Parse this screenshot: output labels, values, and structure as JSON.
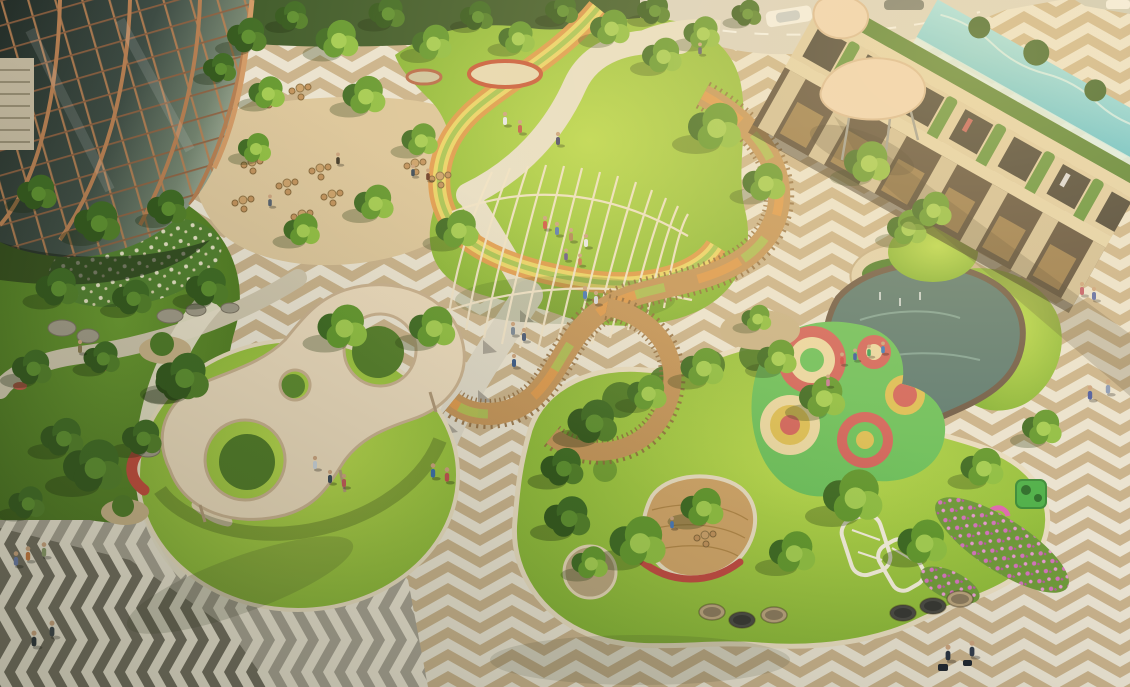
{
  "scene": {
    "title": "Aerial architectural rendering of a landscaped mixed-use plaza and park at golden hour",
    "elements": [
      "glass-office-tower",
      "cafe-terrace",
      "street-with-cars",
      "central-lawn",
      "lattice-pavilion",
      "rainbow-loop-path",
      "elevated-timber-ramp",
      "sculpted-canopy-pavilion",
      "play-mound-with-slides",
      "chevron-plaza",
      "retail-arcade-building",
      "rooftop-pool",
      "umbrella-canopy",
      "water-feature",
      "playground-mat",
      "flower-beds",
      "lounge-pods",
      "white-trellis",
      "garden-with-boulders"
    ],
    "trees": [
      [
        245,
        38,
        1.2,
        "d"
      ],
      [
        290,
        18,
        1.0,
        "d"
      ],
      [
        335,
        42,
        1.3,
        "m"
      ],
      [
        385,
        15,
        1.1,
        "d"
      ],
      [
        430,
        45,
        1.2,
        "m"
      ],
      [
        475,
        18,
        1.0,
        "d"
      ],
      [
        515,
        40,
        1.1,
        "m"
      ],
      [
        560,
        12,
        1.0,
        "d"
      ],
      [
        608,
        30,
        1.2,
        "m"
      ],
      [
        652,
        12,
        1.0,
        "d"
      ],
      [
        700,
        35,
        1.1,
        "m"
      ],
      [
        745,
        15,
        0.9,
        "d"
      ],
      [
        218,
        70,
        1.0,
        "d"
      ],
      [
        265,
        95,
        1.1,
        "m"
      ],
      [
        362,
        98,
        1.3,
        "m"
      ],
      [
        418,
        142,
        1.1,
        "m"
      ],
      [
        372,
        205,
        1.2,
        "m"
      ],
      [
        300,
        232,
        1.1,
        "m"
      ],
      [
        253,
        150,
        1.0,
        "m"
      ],
      [
        455,
        232,
        1.3,
        "m"
      ],
      [
        35,
        195,
        1.2,
        "d"
      ],
      [
        95,
        225,
        1.4,
        "d"
      ],
      [
        165,
        210,
        1.2,
        "d"
      ],
      [
        55,
        290,
        1.3,
        "d"
      ],
      [
        130,
        300,
        1.2,
        "d"
      ],
      [
        205,
        290,
        1.3,
        "d"
      ],
      [
        30,
        370,
        1.2,
        "d"
      ],
      [
        100,
        360,
        1.1,
        "d"
      ],
      [
        175,
        385,
        1.3,
        "d"
      ],
      [
        60,
        440,
        1.3,
        "d"
      ],
      [
        140,
        440,
        1.2,
        "d"
      ],
      [
        90,
        470,
        1.8,
        "d"
      ],
      [
        25,
        505,
        1.1,
        "d"
      ],
      [
        180,
        380,
        1.6,
        "d"
      ],
      [
        340,
        330,
        1.5,
        "m"
      ],
      [
        430,
        330,
        1.4,
        "m"
      ],
      [
        712,
        130,
        1.6,
        "m"
      ],
      [
        762,
        185,
        1.3,
        "m"
      ],
      [
        660,
        58,
        1.2,
        "m"
      ],
      [
        865,
        165,
        1.4,
        "m"
      ],
      [
        905,
        230,
        1.2,
        "m"
      ],
      [
        930,
        212,
        1.2,
        "m"
      ],
      [
        590,
        425,
        1.5,
        "d"
      ],
      [
        645,
        395,
        1.2,
        "m"
      ],
      [
        700,
        370,
        1.3,
        "m"
      ],
      [
        560,
        470,
        1.3,
        "d"
      ],
      [
        775,
        360,
        1.2,
        "m"
      ],
      [
        820,
        400,
        1.4,
        "m"
      ],
      [
        635,
        545,
        1.7,
        "m"
      ],
      [
        565,
        520,
        1.4,
        "d"
      ],
      [
        700,
        510,
        1.3,
        "m"
      ],
      [
        850,
        500,
        1.8,
        "m"
      ],
      [
        920,
        545,
        1.5,
        "m"
      ],
      [
        790,
        555,
        1.4,
        "m"
      ],
      [
        980,
        470,
        1.3,
        "m"
      ],
      [
        1040,
        430,
        1.2,
        "m"
      ],
      [
        588,
        565,
        1.1,
        "m"
      ],
      [
        755,
        320,
        0.9,
        "m"
      ]
    ],
    "people": [
      [
        80,
        346,
        1,
        "#8a7a52"
      ],
      [
        433,
        470,
        1.1,
        "#3a6ea8"
      ],
      [
        447,
        474,
        1.1,
        "#c05050"
      ],
      [
        505,
        118,
        1,
        "#e8e8ee"
      ],
      [
        520,
        126,
        1,
        "#c05a4a"
      ],
      [
        558,
        138,
        1,
        "#48486a"
      ],
      [
        545,
        222,
        1,
        "#d05848"
      ],
      [
        557,
        228,
        1,
        "#5a7ab0"
      ],
      [
        571,
        234,
        1,
        "#b08858"
      ],
      [
        586,
        240,
        1,
        "#e8e8e8"
      ],
      [
        566,
        254,
        0.9,
        "#6a5a8a"
      ],
      [
        580,
        259,
        0.9,
        "#c87850"
      ],
      [
        585,
        292,
        1,
        "#4878b8"
      ],
      [
        596,
        297,
        1,
        "#d8d8e0"
      ],
      [
        513,
        328,
        1,
        "#7a8898"
      ],
      [
        524,
        334,
        1,
        "#4a5a78"
      ],
      [
        514,
        360,
        1,
        "#385888"
      ],
      [
        413,
        170,
        0.9,
        "#384858"
      ],
      [
        428,
        174,
        0.9,
        "#6a3a28"
      ],
      [
        338,
        158,
        0.9,
        "#403828"
      ],
      [
        270,
        200,
        0.9,
        "#55606e"
      ],
      [
        28,
        553,
        1.1,
        "#c87840"
      ],
      [
        44,
        549,
        1.1,
        "#8a9a6a"
      ],
      [
        16,
        558,
        1.1,
        "#6878a8"
      ],
      [
        52,
        628,
        1.2,
        "#384048"
      ],
      [
        34,
        638,
        1.2,
        "#283038"
      ],
      [
        948,
        652,
        1.2,
        "#283240"
      ],
      [
        972,
        648,
        1.2,
        "#323c4c"
      ],
      [
        1082,
        288,
        1,
        "#c05868"
      ],
      [
        1094,
        293,
        1,
        "#5868a8"
      ],
      [
        1090,
        392,
        1.1,
        "#4858a0"
      ],
      [
        1108,
        386,
        1.1,
        "#8898b8"
      ],
      [
        842,
        358,
        0.9,
        "#d04848"
      ],
      [
        855,
        354,
        0.9,
        "#3858a0"
      ],
      [
        869,
        350,
        0.9,
        "#38a058"
      ],
      [
        883,
        347,
        0.9,
        "#3878c0"
      ],
      [
        828,
        380,
        0.9,
        "#c87898"
      ],
      [
        315,
        462,
        1,
        "#c8d0d8"
      ],
      [
        330,
        476,
        1,
        "#384858"
      ],
      [
        344,
        480,
        1,
        "#c05858"
      ],
      [
        672,
        522,
        0.9,
        "#4878b8"
      ],
      [
        700,
        48,
        0.9,
        "#5a5a6a"
      ]
    ],
    "seat_sets": [
      [
        252,
        162
      ],
      [
        287,
        183
      ],
      [
        243,
        200
      ],
      [
        320,
        168
      ],
      [
        302,
        214
      ],
      [
        332,
        194
      ],
      [
        415,
        163
      ],
      [
        440,
        176
      ],
      [
        268,
        96
      ],
      [
        300,
        88
      ],
      [
        705,
        535
      ]
    ],
    "pods": [
      [
        712,
        612,
        "#b8a27c"
      ],
      [
        742,
        620,
        "#4a4a44"
      ],
      [
        774,
        615,
        "#b8a27c"
      ],
      [
        903,
        613,
        "#4a4a44"
      ],
      [
        933,
        606,
        "#4a4a44"
      ],
      [
        960,
        599,
        "#b8a27c"
      ]
    ],
    "boulders": [
      [
        62,
        328,
        14,
        8
      ],
      [
        88,
        336,
        11,
        7
      ],
      [
        170,
        316,
        13,
        7
      ],
      [
        196,
        310,
        10,
        6
      ],
      [
        230,
        308,
        9,
        5
      ],
      [
        148,
        450,
        12,
        7
      ]
    ]
  },
  "colors": {
    "grass_sun": "#b9d94e",
    "grass_mid": "#7fae34",
    "grass_shade_hi": "#6a9a30",
    "grass_shade_lo": "#47701f",
    "tree_dark": "#3f6b24",
    "tree_mid": "#63982f",
    "tree_light": "#8fbe43",
    "tree_deep": "#33581d",
    "tree_deep2": "#527f2a",
    "plaza_cream": "#eae3d2",
    "plaza_tan": "#c9b28c",
    "plaza_gray": "#a8a294",
    "plaza_dark": "#716c5f",
    "path_cream": "#e7dfc9",
    "path_warm": "#dcc69c",
    "path_gray": "#ded8c8",
    "rainbow_orange": "#e09a4e",
    "rainbow_yellow": "#ead468",
    "rainbow_green": "#a8c455",
    "deck_wood": "#c3945a",
    "deck_rail": "#8f6a3e",
    "deck_light": "#cfa468",
    "canopy_cream": "#ead9bc",
    "canopy_edge": "#c9b190",
    "slide_red": "#c24a3c",
    "bench_red": "#c04a42",
    "lattice": "#efe3c9",
    "glass_1": "#232d28",
    "glass_2": "#3e4c44",
    "glass_3": "#73836f",
    "glass_4": "#a3b09c",
    "copper": "#b57e52",
    "copper_dark": "#8f6040",
    "copper_bright": "#d29a66",
    "building_band": "#e2d2ac",
    "building_cream": "#dccaa4",
    "building_pier": "#cfbd98",
    "opening_dark": "#3f3a32",
    "arcade_dark": "#57493a",
    "glow_warm": "#caa05c",
    "vine_green": "#5c8f3a",
    "hedge_green": "#4e7d2f",
    "pool_light": "#9fe2ec",
    "pool_blue": "#57bfd2",
    "pool_glass": "#d8f2f4",
    "pond_water": "#5c7a72",
    "pond_edge": "#6e5a48",
    "play_green": "#6cc05c",
    "play_red": "#d2645c",
    "play_cream": "#ead7a2",
    "play_yellow": "#ddbe55",
    "flower_pink": "#d473bd",
    "flower_pink_light": "#e79ad2",
    "flower_white": "#f2ead2",
    "road": "#d8d2c4",
    "car_white": "#f2f0ea",
    "car_gray": "#70756f",
    "umbrella": "#eed3b6",
    "umbrella_edge": "#d8b894",
    "pot_tan": "#c8b288",
    "boulder": "#a09a88",
    "glow": "#ffe29e",
    "shade": "#2c3420"
  }
}
